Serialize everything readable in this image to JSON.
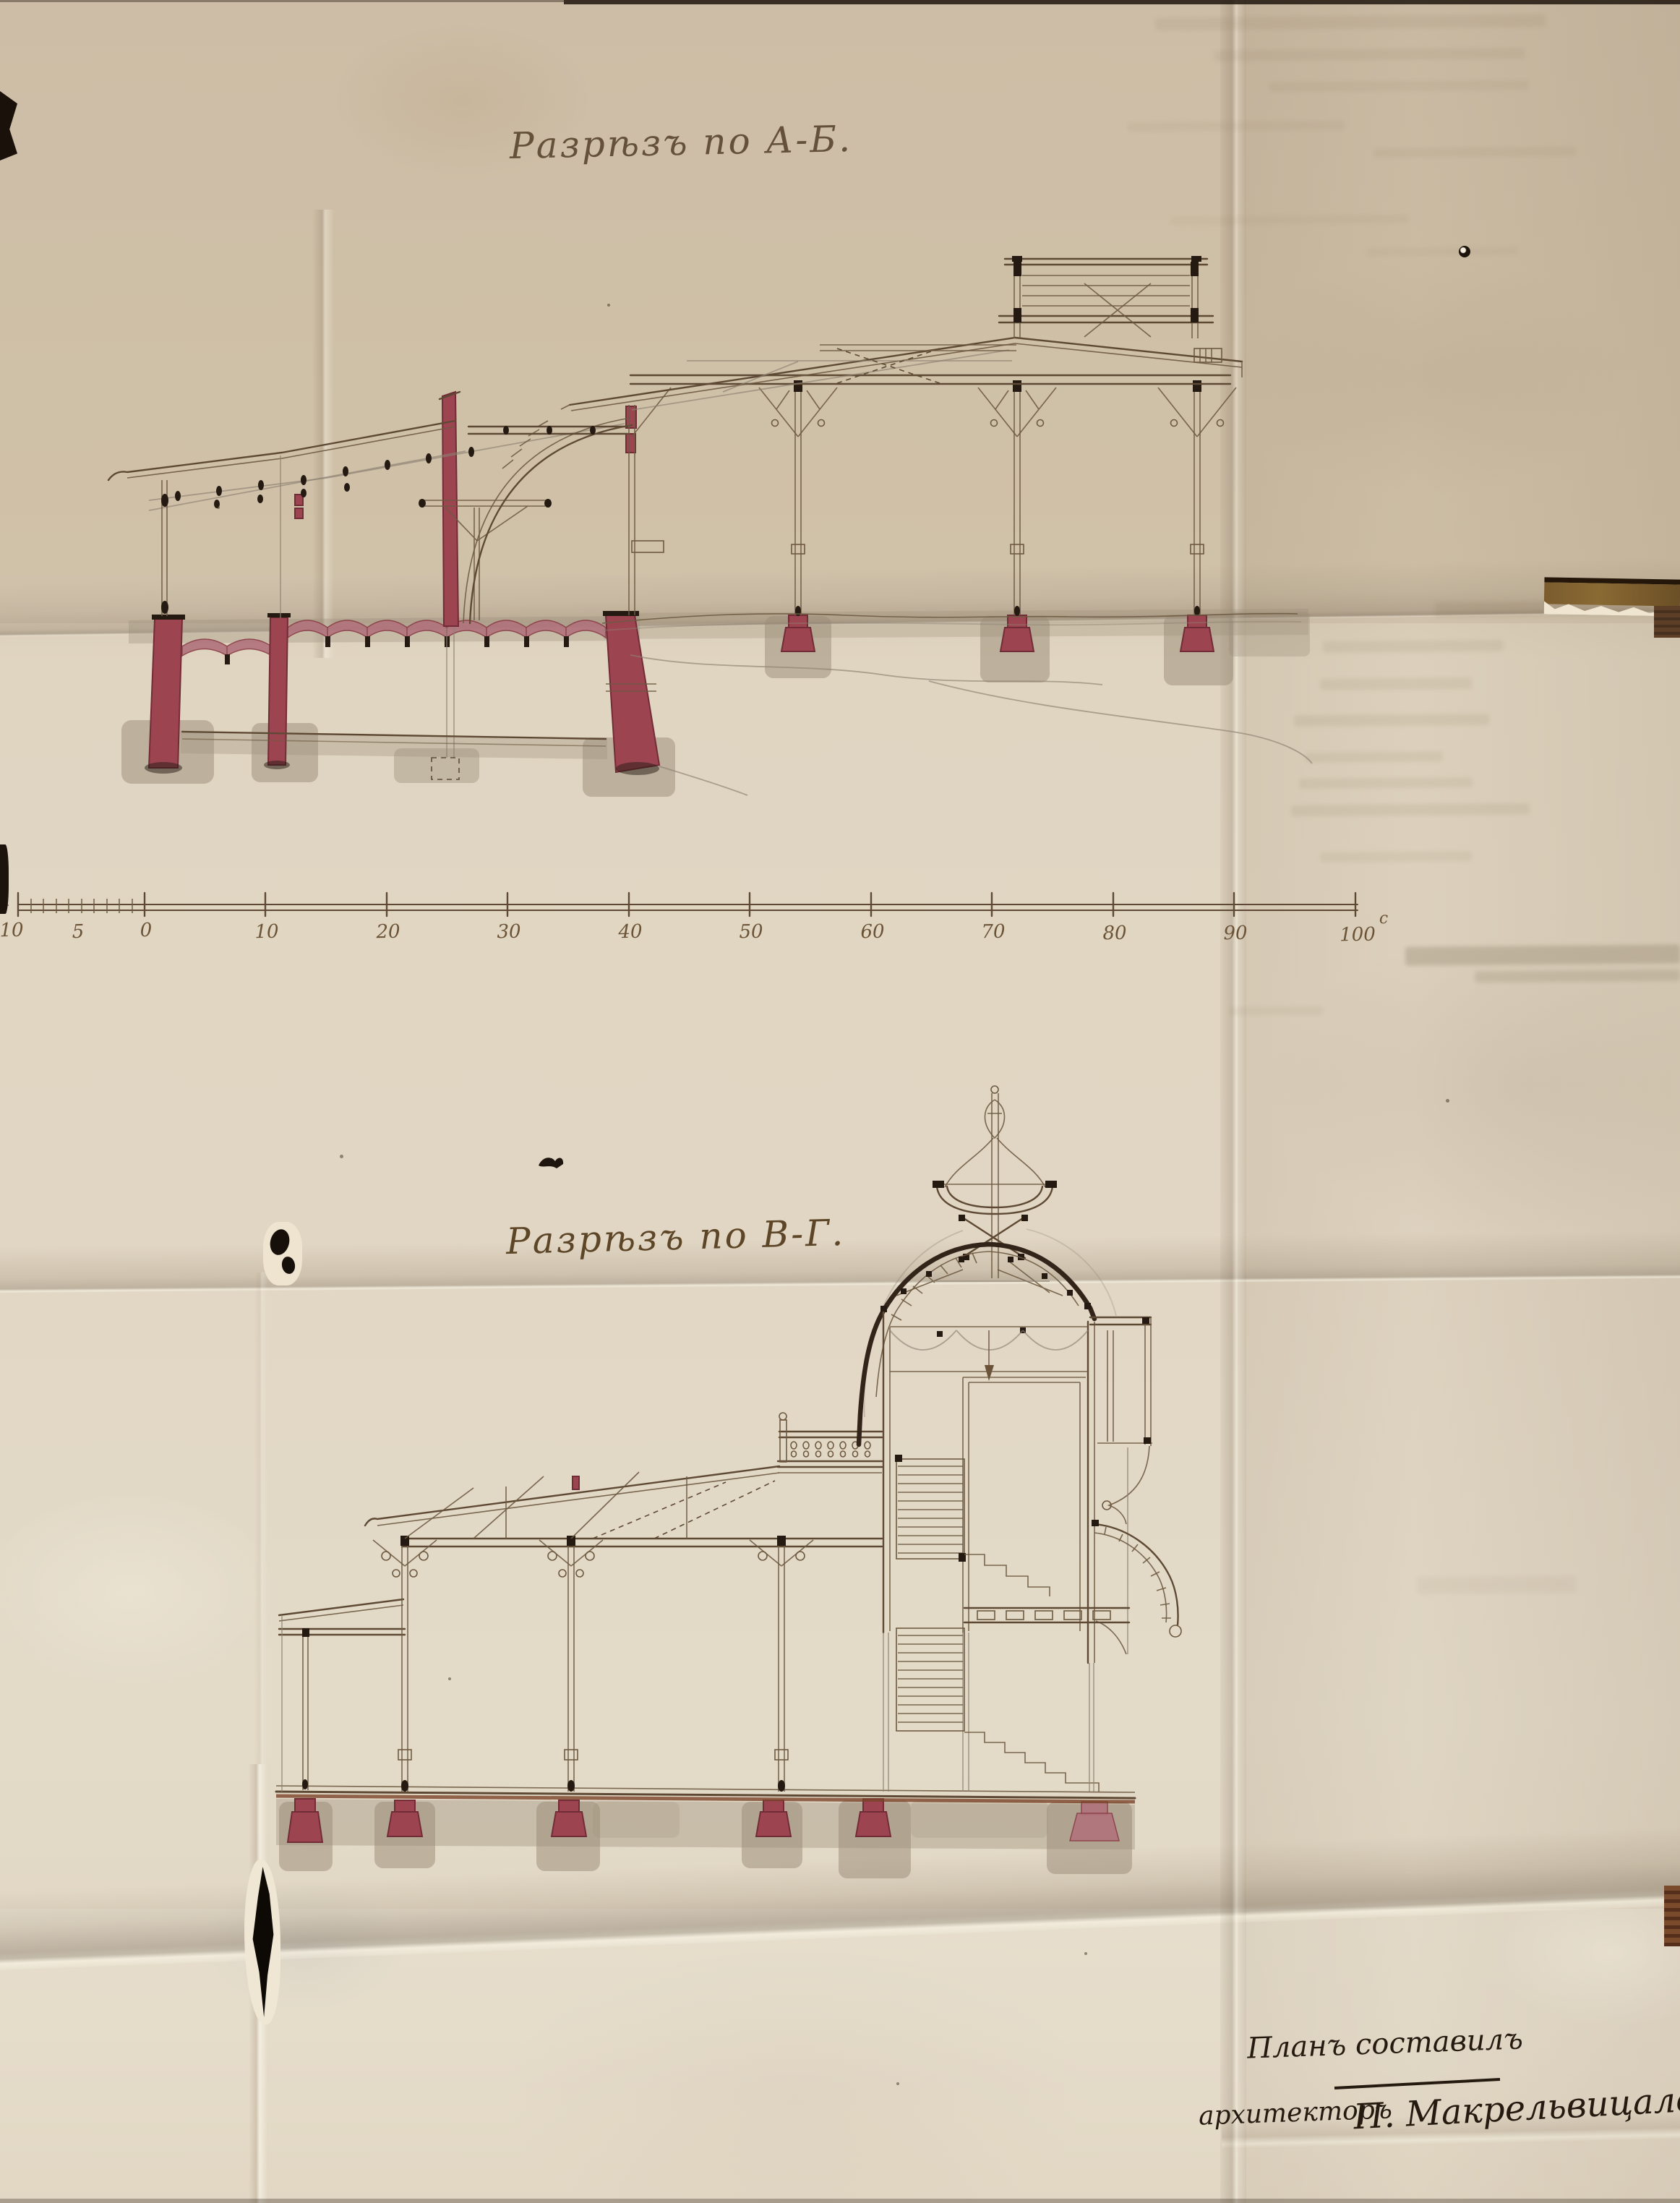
{
  "titles": {
    "section_ab": "Разрѣзъ по А-Б.",
    "section_vg": "Разрѣзъ по В-Г."
  },
  "scale_bar": {
    "labels": [
      "10",
      "5",
      "0",
      "10",
      "20",
      "30",
      "40",
      "50",
      "60",
      "70",
      "80",
      "90",
      "100"
    ],
    "unit_mark": "с"
  },
  "signature": {
    "line1": "Планъ составилъ",
    "role": "архитекторъ",
    "name": "П. Макрельвицаловъ."
  },
  "colors": {
    "paper": "#dccfba",
    "ink_line": "#5e4a34",
    "pencil": "#8d8172",
    "crimson": "#9d4451",
    "crimson_dark": "#722c37",
    "arch_pink": "#b0737c",
    "wash_grey": "#998b78",
    "handwriting": "#65503a",
    "signature_ink": "#241a10",
    "table_wood": "#2c1f14"
  }
}
